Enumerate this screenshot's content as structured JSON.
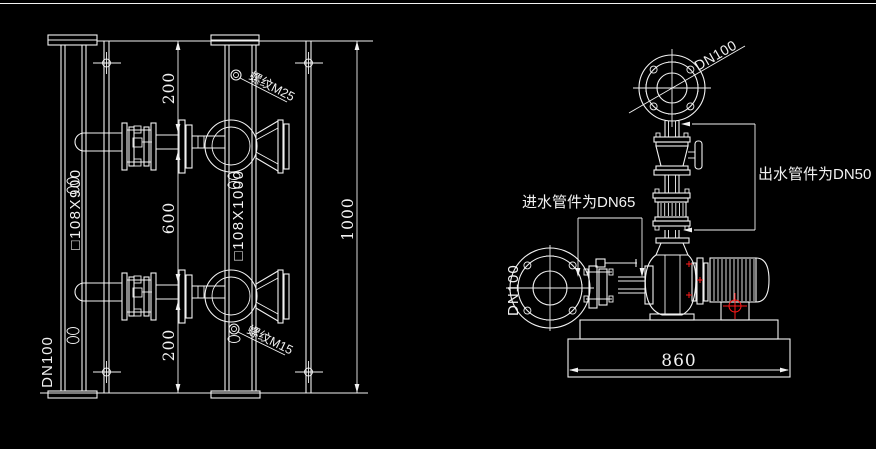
{
  "canvas": {
    "bg": "#000000",
    "line": "#f2f2f2",
    "accent_red": "#ff1a1a"
  },
  "left_view": {
    "suction_header_label": "□108X900",
    "suction_header_dn": "DN100",
    "discharge_header_label": "□108X1000",
    "thread_note_top": "螺纹M25",
    "thread_note_bottom": "螺纹M15",
    "dim_top": "200",
    "dim_middle": "600",
    "dim_bottom": "200",
    "dim_overall": "1000"
  },
  "right_view": {
    "top_flange_dn": "DN100",
    "outlet_note": "出水管件为DN50",
    "inlet_note": "进水管件为DN65",
    "inlet_flange_dn": "DN100",
    "base_dim": "860"
  }
}
